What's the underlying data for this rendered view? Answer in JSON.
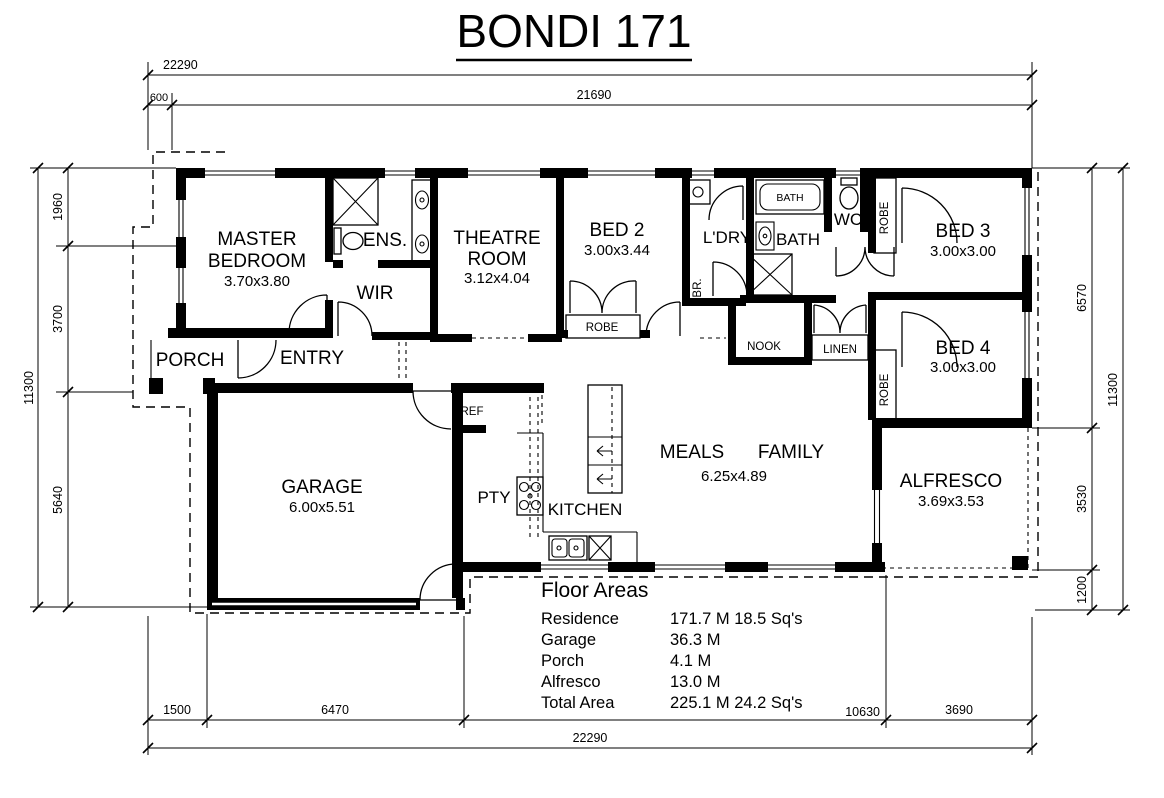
{
  "title": "BONDI 171",
  "dimensions": {
    "top": {
      "overall": "22290",
      "offset": "600",
      "main": "21690"
    },
    "bottom": {
      "overall": "22290",
      "segs": [
        "1500",
        "6470",
        "10630",
        "3690"
      ]
    },
    "left": {
      "overall": "11300",
      "segs": [
        "1960",
        "3700",
        "5640"
      ]
    },
    "right": {
      "overall": "11300",
      "segs": [
        "6570",
        "3530",
        "1200"
      ]
    }
  },
  "rooms": {
    "master": {
      "line1": "MASTER",
      "line2": "BEDROOM",
      "size": "3.70x3.80"
    },
    "ens": {
      "label": "ENS."
    },
    "wir": {
      "label": "WIR"
    },
    "porch": {
      "label": "PORCH"
    },
    "entry": {
      "label": "ENTRY"
    },
    "theatre": {
      "line1": "THEATRE",
      "line2": "ROOM",
      "size": "3.12x4.04"
    },
    "bed2": {
      "label": "BED 2",
      "size": "3.00x3.44"
    },
    "robe2": {
      "label": "ROBE"
    },
    "ldry": {
      "label": "L'DRY"
    },
    "br": {
      "label": "BR."
    },
    "bath": {
      "label": "BATH"
    },
    "bathtub": {
      "label": "BATH"
    },
    "wc": {
      "label": "WC"
    },
    "robe3": {
      "label": "ROBE"
    },
    "bed3": {
      "label": "BED 3",
      "size": "3.00x3.00"
    },
    "nook": {
      "label": "NOOK"
    },
    "linen": {
      "label": "LINEN"
    },
    "robe4": {
      "label": "ROBE"
    },
    "bed4": {
      "label": "BED 4",
      "size": "3.00x3.00"
    },
    "garage": {
      "label": "GARAGE",
      "size": "6.00x5.51"
    },
    "ref": {
      "label": "REF"
    },
    "pty": {
      "label": "PTY"
    },
    "kitchen": {
      "label": "KITCHEN"
    },
    "meals": {
      "label": "MEALS"
    },
    "family": {
      "label": "FAMILY"
    },
    "meals_family_size": "6.25x4.89",
    "alfresco": {
      "label": "ALFRESCO",
      "size": "3.69x3.53"
    }
  },
  "floor_areas": {
    "title": "Floor Areas",
    "rows": [
      {
        "label": "Residence",
        "value": "171.7 M 18.5 Sq's"
      },
      {
        "label": "Garage",
        "value": "36.3 M"
      },
      {
        "label": "Porch",
        "value": "4.1 M"
      },
      {
        "label": "Alfresco",
        "value": "13.0 M"
      },
      {
        "label": "Total Area",
        "value": "225.1 M 24.2 Sq's"
      }
    ]
  },
  "colors": {
    "ink": "#000000",
    "paper": "#ffffff"
  }
}
